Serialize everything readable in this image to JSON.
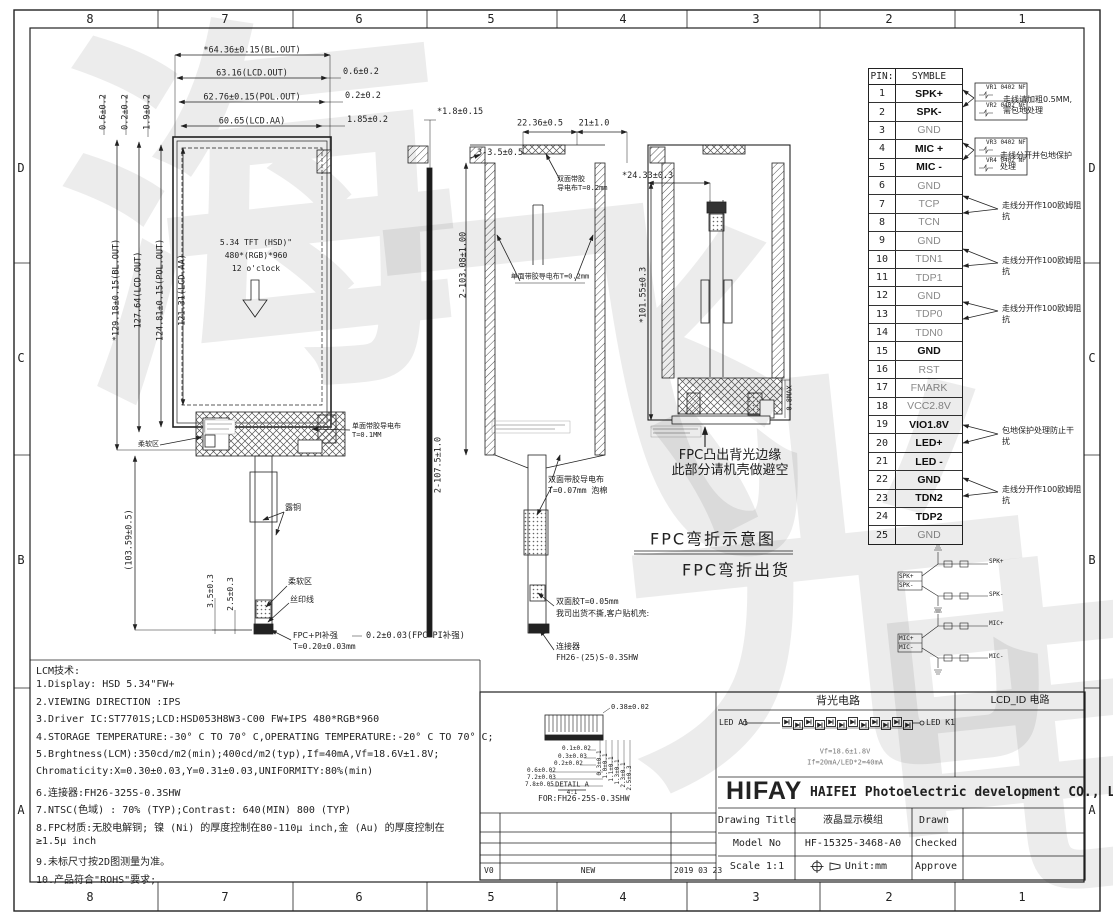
{
  "watermark": {
    "chars": [
      "海",
      "飞",
      "光",
      "电"
    ]
  },
  "grid": {
    "cols": [
      "8",
      "7",
      "6",
      "5",
      "4",
      "3",
      "2",
      "1"
    ],
    "rows": [
      "D",
      "C",
      "B",
      "A"
    ]
  },
  "front_view": {
    "dim_top1": "*64.36±0.15(BL.OUT)",
    "dim_top2": "63.16(LCD.OUT)",
    "dim_top3": "62.76±0.15(POL.OUT)",
    "dim_top4": "60.65(LCD.AA)",
    "dim_r1": "0.6±0.2",
    "dim_r2": "0.2±0.2",
    "dim_r3": "1.85±0.2",
    "dim_tl1": "0.6±0.2",
    "dim_tl2": "0.2±0.2",
    "dim_tl3": "1.9±0.2",
    "dim_l1": "*129.18±0.15(BL.OUT)",
    "dim_l2": "127.64(LCD.OUT)",
    "dim_l3": "124.81±0.15(POL.OUT)",
    "dim_l4": "121.31(LCD.AA)",
    "dim_l5": "(103.59±0.5)",
    "screen1": "5.34 TFT (HSD)\"",
    "screen2": "480*(RGB)*960",
    "screen3": "12 o'clock",
    "soft_zone": "柔软区",
    "cond1": "单面带胶导电布",
    "cond2": "T=0.1MM",
    "copper": "露铜",
    "silk": "丝印线",
    "stiff1": "FPC+PI补强",
    "stiff2": "T=0.20±0.03mm",
    "dim_t1": "3.5±0.3",
    "dim_t2": "2.5±0.3",
    "dim_bot": "0.2±0.03(FPC+PI补强)"
  },
  "edge_view": {
    "dim_th": "*1.8±0.15"
  },
  "section_view": {
    "dim_top1": "22.36±0.5",
    "dim_top2": "21±1.0",
    "dim_side": "3-3.5±0.5",
    "tape_top1": "双面带胶",
    "tape_top2": "导电布T=0.2mm",
    "dim_h1": "2-103.08±1.00",
    "dim_h2": "2-107.5±1.0",
    "tape_mid": "单面带胶导电布T=0.2mm",
    "foam1": "双面带胶导电布",
    "foam2": "T=0.07mm 泡棉",
    "tape1": "双面胶T=0.05mm",
    "tape2": "我司出货不撕,客户贴机壳:",
    "conn1": "连接器",
    "conn2": "FH26-(25)S-0.3SHW"
  },
  "rear_view": {
    "dim_w": "*24.33±0.3",
    "dim_h": "*101.55±0.3",
    "dim_max": "0.8MAX",
    "note1": "FPC凸出背光边缘",
    "note2": "此部分请机壳做避空"
  },
  "fpc_bend": {
    "line1": "FPC弯折示意图",
    "line2": "FPC弯折出货"
  },
  "pin_table": {
    "col1": "PIN:",
    "col2": "SYMBLE",
    "rows": [
      {
        "pin": "1",
        "sym": "SPK+",
        "b": 1
      },
      {
        "pin": "2",
        "sym": "SPK-",
        "b": 1
      },
      {
        "pin": "3",
        "sym": "GND",
        "b": 0
      },
      {
        "pin": "4",
        "sym": "MIC +",
        "b": 1
      },
      {
        "pin": "5",
        "sym": "MIC -",
        "b": 1
      },
      {
        "pin": "6",
        "sym": "GND",
        "b": 0
      },
      {
        "pin": "7",
        "sym": "TCP",
        "b": 0
      },
      {
        "pin": "8",
        "sym": "TCN",
        "b": 0
      },
      {
        "pin": "9",
        "sym": "GND",
        "b": 0
      },
      {
        "pin": "10",
        "sym": "TDN1",
        "b": 0
      },
      {
        "pin": "11",
        "sym": "TDP1",
        "b": 0
      },
      {
        "pin": "12",
        "sym": "GND",
        "b": 0
      },
      {
        "pin": "13",
        "sym": "TDP0",
        "b": 0
      },
      {
        "pin": "14",
        "sym": "TDN0",
        "b": 0
      },
      {
        "pin": "15",
        "sym": "GND",
        "b": 1
      },
      {
        "pin": "16",
        "sym": "RST",
        "b": 0
      },
      {
        "pin": "17",
        "sym": "FMARK",
        "b": 0
      },
      {
        "pin": "18",
        "sym": "VCC2.8V",
        "b": 0
      },
      {
        "pin": "19",
        "sym": "VIO1.8V",
        "b": 1
      },
      {
        "pin": "20",
        "sym": "LED+",
        "b": 1
      },
      {
        "pin": "21",
        "sym": "LED -",
        "b": 1
      },
      {
        "pin": "22",
        "sym": "GND",
        "b": 1
      },
      {
        "pin": "23",
        "sym": "TDN2",
        "b": 1
      },
      {
        "pin": "24",
        "sym": "TDP2",
        "b": 1
      },
      {
        "pin": "25",
        "sym": "GND",
        "b": 0
      }
    ]
  },
  "pin_notes": {
    "vr1": "VR1 0402 NF",
    "vr2": "VR2 0402 NF",
    "vr3": "VR3 0402 NF",
    "vr4": "VR4 0402 NF",
    "spk1": "走线请加粗0.5MM,",
    "spk2": "需包地处理",
    "mic1": "走线分开并包地保护",
    "mic2": "处理",
    "imp1": "走线分开作100欧姆阻",
    "imp2": "抗",
    "led1": "包地保护处理防止干",
    "led2": "扰"
  },
  "mini_sch": {
    "spkp": "SPK+",
    "spkm": "SPK-",
    "micp": "MIC+",
    "micm": "MIC-"
  },
  "notes": {
    "lines": [
      "LCM技术:",
      "1.Display: HSD 5.34\"FW+",
      "2.VIEWING DIRECTION :IPS",
      "3.Driver IC:ST7701S;LCD:HSD053H8W3-C00  FW+IPS 480*RGB*960",
      "4.STORAGE TEMPERATURE:-30° C TO 70° C,OPERATING TEMPERATURE:-20° C TO 70° C;",
      "5.Brghtness(LCM):350cd/m2(min);400cd/m2(typ),If=40mA,Vf=18.6V±1.8V;",
      "    Chromaticity:X=0.30±0.03,Y=0.31±0.03,UNIFORMITY:80%(min)",
      "6.连接器:FH26-325S-0.3SHW",
      "7.NTSC(色域) : 70% (TYP);Contrast:  640(MIN)   800 (TYP)",
      "8.FPC材质:无胶电解铜; 镍 (Ni) 的厚度控制在80-110μ inch,金 (Au) 的厚度控制在",
      "≥1.5μ inch",
      "9.未标尺寸按2D图测量为准。",
      "10.产品符合\"ROHS\"要求;"
    ]
  },
  "detail": {
    "dim_top": "0.38±0.02",
    "d1": "0.1±0.02",
    "d2": "0.3±0.03",
    "d3": "0.2±0.02",
    "d4": "0.6±0.02",
    "d5": "7.2±0.03",
    "d6": "7.8±0.05",
    "r1": "0.3±0.1",
    "r2": "1.0±0.1",
    "r3": "1.1±0.1",
    "r4": "1.3±0.1",
    "r5": "2.3±0.1",
    "r6": "2.5±0.3",
    "name": "DETAIL A",
    "scale": "4:1",
    "for_text": "FOR:FH26-25S-0.3SHW"
  },
  "revision": {
    "ver": "V0",
    "desc": "NEW",
    "date": "2019 03 23"
  },
  "backlight": {
    "title": "背光电路",
    "lcd_id_title": "LCD_ID 电路",
    "led_a": "LED A1",
    "led_k": "LED K1",
    "vf": "Vf=18.6±1.8V",
    "if_text": "If=20mA/LED*2=40mA"
  },
  "company": {
    "logo": "HIFAY",
    "name": "HAIFEI Photoelectric development CO., LTD"
  },
  "title_block": {
    "r1_label": "Drawing Title",
    "r1_value": "液晶显示模组",
    "r1_right": "Drawn",
    "r2_label": "Model No",
    "r2_value": "HF-15325-3468-A0",
    "r2_right": "Checked",
    "r3_label": "Scale 1:1",
    "r3_value": "Unit:mm",
    "r3_right": "Approve"
  }
}
